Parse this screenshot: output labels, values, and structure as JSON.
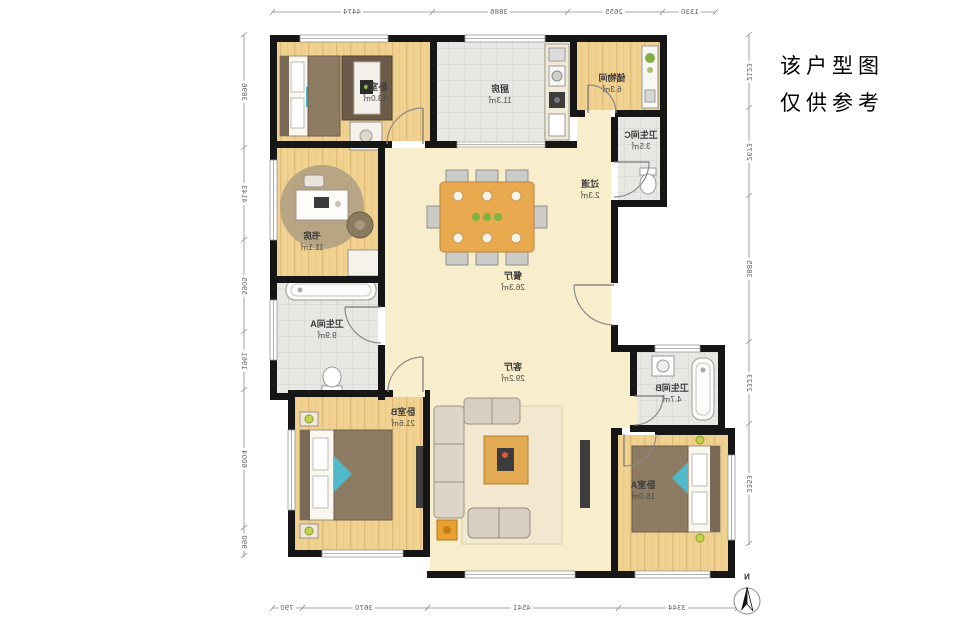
{
  "annotation": {
    "line1": "该户型图",
    "line2": "仅供参考"
  },
  "compass": {
    "north_label": "N"
  },
  "rooms": {
    "bedroomC": {
      "name": "卧室C",
      "area": "13.0㎡"
    },
    "kitchen": {
      "name": "厨房",
      "area": "11.3㎡"
    },
    "storage": {
      "name": "储物间",
      "area": "6.3㎡"
    },
    "bathC": {
      "name": "卫生间C",
      "area": "3.5㎡"
    },
    "hallway": {
      "name": "过道",
      "area": "2.3㎡"
    },
    "study": {
      "name": "书房",
      "area": "11.1㎡"
    },
    "dining": {
      "name": "餐厅",
      "area": "26.3㎡"
    },
    "bathA": {
      "name": "卫生间A",
      "area": "9.9㎡"
    },
    "living": {
      "name": "客厅",
      "area": "29.2㎡"
    },
    "bedroomB": {
      "name": "卧室B",
      "area": "21.6㎡"
    },
    "bathB": {
      "name": "卫生间B",
      "area": "4.7㎡"
    },
    "bedroomA": {
      "name": "卧室A",
      "area": "15.0㎡"
    }
  },
  "dimensions": {
    "top": [
      "4474",
      "3886",
      "2655",
      "1330"
    ],
    "bottom": [
      "790",
      "3670",
      "4541",
      "3344"
    ],
    "left": [
      "3896",
      "4143",
      "5905",
      "1961",
      "6004",
      "990"
    ],
    "right": [
      "2123",
      "2673",
      "3885",
      "2323",
      "3353"
    ]
  },
  "colors": {
    "wall": "#161616",
    "wood_floor": "#f1d190",
    "tile_floor": "#e7e7e4",
    "cream_floor": "#f8eecb",
    "table_accent": "#e9a94f"
  }
}
